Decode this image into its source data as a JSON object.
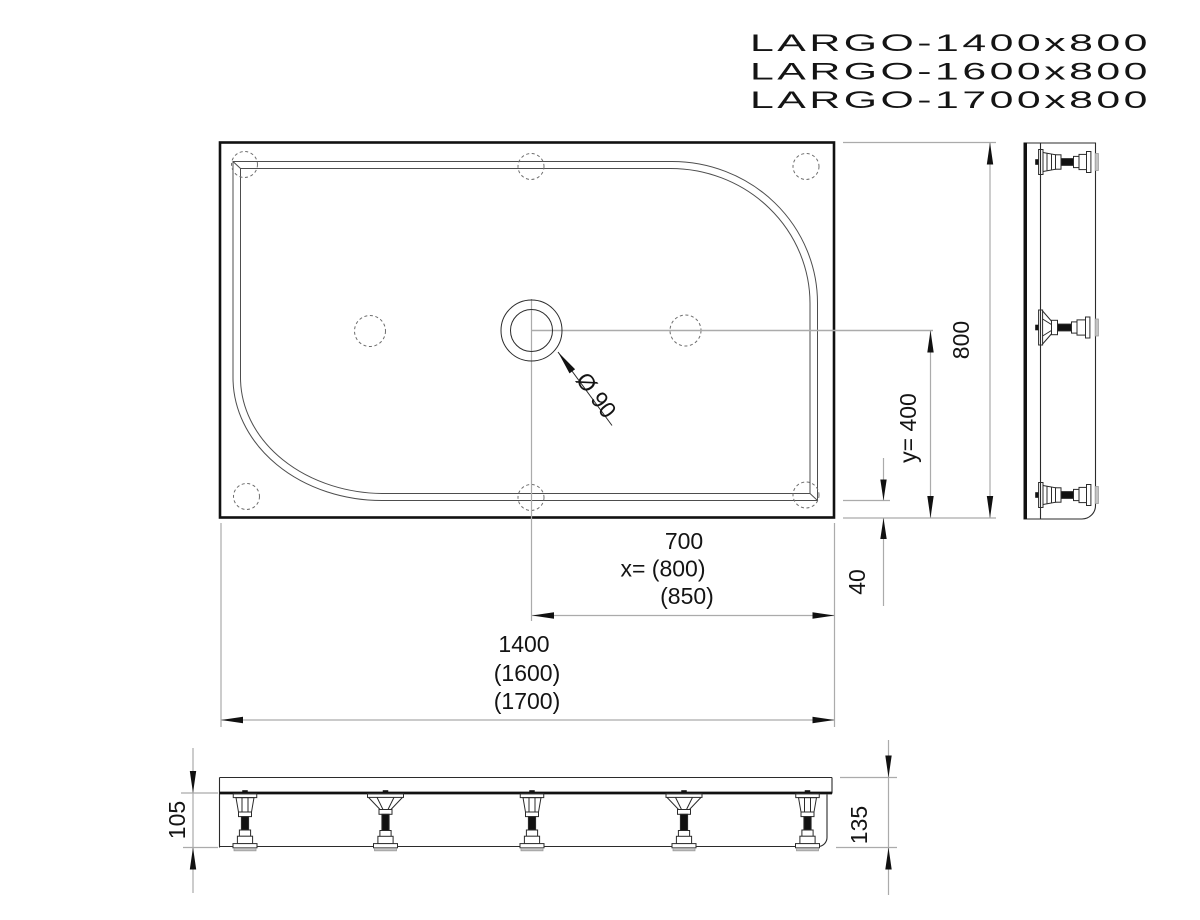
{
  "title_models": [
    "LARGO-1400x800",
    "LARGO-1600x800",
    "LARGO-1700x800"
  ],
  "top_view": {
    "drain_label": "Ø 90"
  },
  "dims": {
    "overall_width": "800",
    "drain_offset_y": "y= 400",
    "rim_to_edge": "40",
    "drain_offset_x": [
      "700",
      "x= (800)",
      "(850)"
    ],
    "overall_length": [
      "1400",
      "(1600)",
      "(1700)"
    ],
    "leg_height": "105",
    "total_height": "135"
  },
  "colors": {
    "line_main": "#111111",
    "line_thin": "#2b2b2b",
    "line_rim": "#4d4d4d",
    "line_aux": "#ababab",
    "dashed": "#6e6e6e"
  }
}
